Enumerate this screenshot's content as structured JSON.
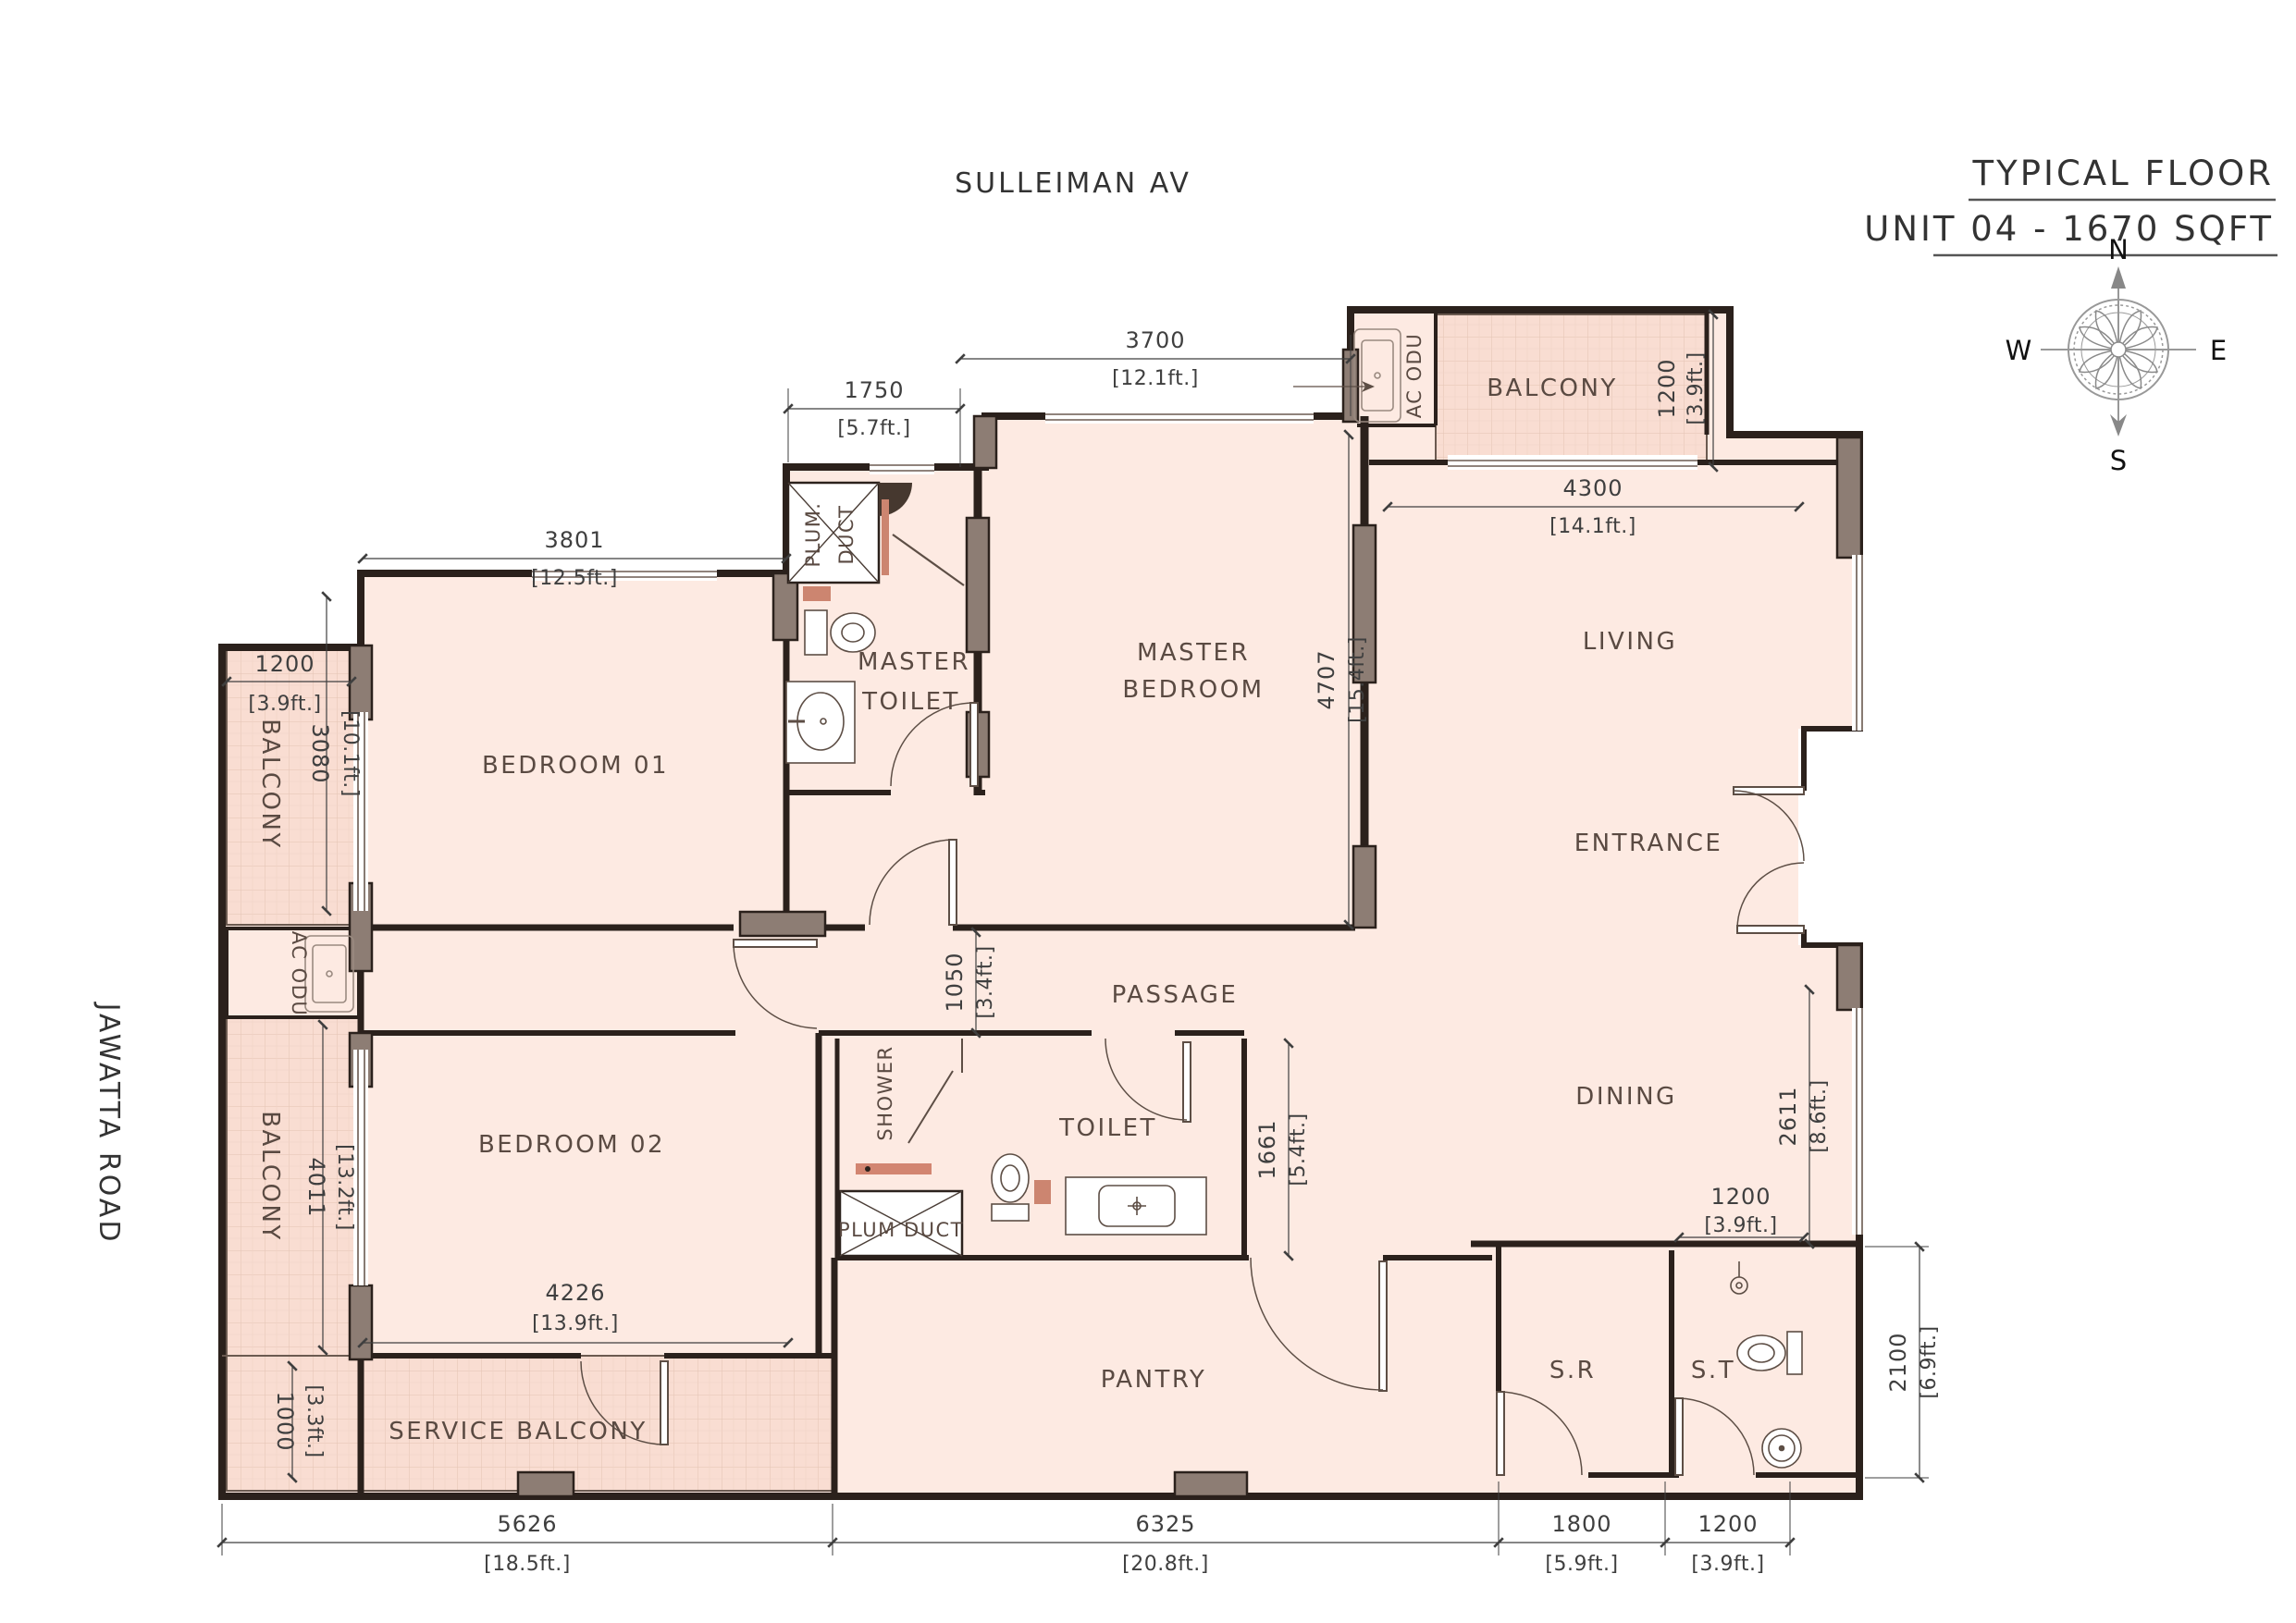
{
  "title": {
    "line1": "TYPICAL FLOOR",
    "line2": "UNIT 04 - 1670 SQFT"
  },
  "streets": {
    "top": "SULLEIMAN AV",
    "left": "JAWATTA ROAD"
  },
  "compass": {
    "n": "N",
    "e": "E",
    "s": "S",
    "w": "W"
  },
  "rooms": {
    "bedroom1": "BEDROOM 01",
    "bedroom2": "BEDROOM 02",
    "master_l1": "MASTER",
    "master_l2": "BEDROOM",
    "mtoilet_l1": "MASTER",
    "mtoilet_l2": "TOILET",
    "living": "LIVING",
    "entrance": "ENTRANCE",
    "passage": "PASSAGE",
    "dining": "DINING",
    "toilet": "TOILET",
    "pantry": "PANTRY",
    "sr": "S.R",
    "st": "S.T",
    "service_balcony": "SERVICE BALCONY",
    "balcony_top": "BALCONY",
    "balcony_left_up": "BALCONY",
    "balcony_left_low": "BALCONY",
    "shower": "SHOWER",
    "plum_master_l1": "PLUM.",
    "plum_master_l2": "DUCT",
    "plum_toilet": "PLUM DUCT",
    "ac_odu_top": "AC ODU",
    "ac_odu_left": "AC ODU"
  },
  "dims": {
    "d3801": {
      "mm": "3801",
      "ft": "[12.5ft.]"
    },
    "d1750": {
      "mm": "1750",
      "ft": "[5.7ft.]"
    },
    "d3700": {
      "mm": "3700",
      "ft": "[12.1ft.]"
    },
    "d4300": {
      "mm": "4300",
      "ft": "[14.1ft.]"
    },
    "d1200bt": {
      "mm": "1200",
      "ft": "[3.9ft.]"
    },
    "d1200bl": {
      "mm": "1200",
      "ft": "[3.9ft.]"
    },
    "d3080": {
      "mm": "3080",
      "ft": "[10.1ft.]"
    },
    "d4011": {
      "mm": "4011",
      "ft": "[13.2ft.]"
    },
    "d4707": {
      "mm": "4707",
      "ft": "[15.4ft.]"
    },
    "d1050": {
      "mm": "1050",
      "ft": "[3.4ft.]"
    },
    "d1661": {
      "mm": "1661",
      "ft": "[5.4ft.]"
    },
    "d2611": {
      "mm": "2611",
      "ft": "[8.6ft.]"
    },
    "d1200d": {
      "mm": "1200",
      "ft": "[3.9ft.]"
    },
    "d4226": {
      "mm": "4226",
      "ft": "[13.9ft.]"
    },
    "d1000": {
      "mm": "1000",
      "ft": "[3.3ft.]"
    },
    "d2100": {
      "mm": "2100",
      "ft": "[6.9ft.]"
    },
    "d5626": {
      "mm": "5626",
      "ft": "[18.5ft.]"
    },
    "d6325": {
      "mm": "6325",
      "ft": "[20.8ft.]"
    },
    "d1800": {
      "mm": "1800",
      "ft": "[5.9ft.]"
    },
    "d1200st": {
      "mm": "1200",
      "ft": "[3.9ft.]"
    }
  },
  "colors": {
    "floor": "#fdeae2",
    "balcony_tile": "#f9ddd2",
    "wall": "#2b211c",
    "column": "#8d7d74",
    "accent": "#cc8570",
    "line": "#5d4e45"
  }
}
